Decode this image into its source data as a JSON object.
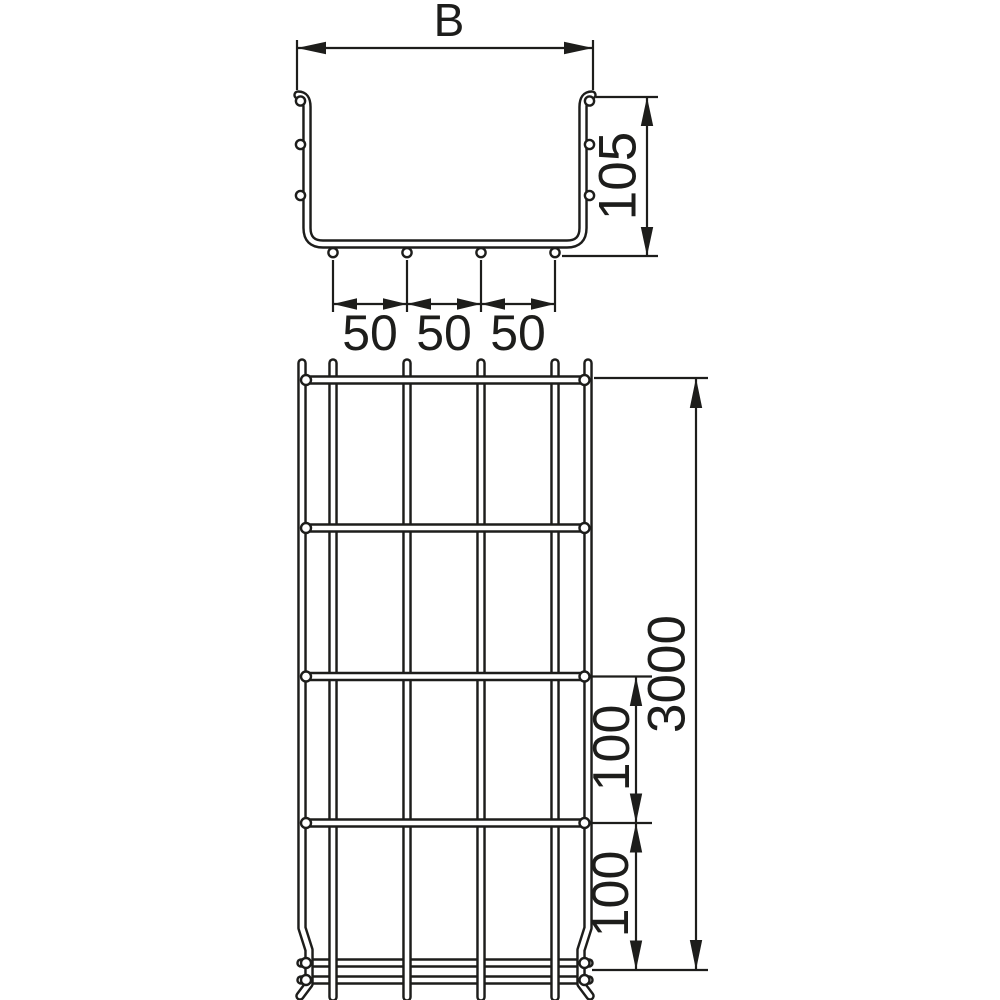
{
  "drawing": {
    "background_color": "#ffffff",
    "line_color": "#1d1d1b",
    "cross_section": {
      "width_label": "B",
      "height_label": "105",
      "spacing_labels": [
        "50",
        "50",
        "50"
      ]
    },
    "plan": {
      "length_label": "3000",
      "pitch_label_upper": "100",
      "pitch_label_lower": "100"
    }
  }
}
